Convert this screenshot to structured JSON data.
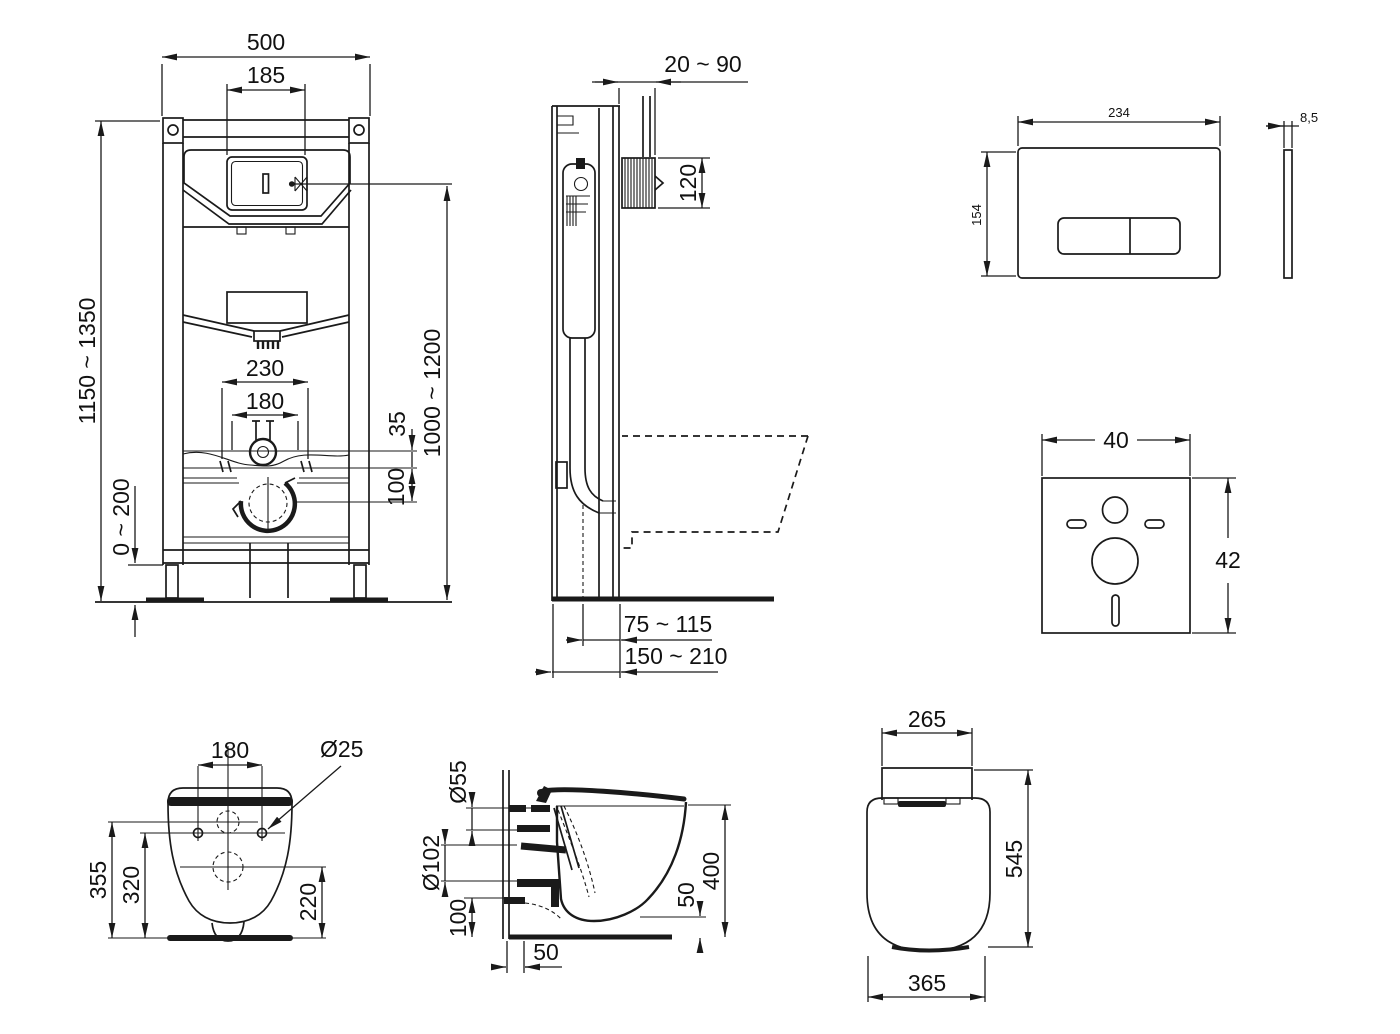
{
  "colors": {
    "line": "#1a1a1a",
    "background": "#ffffff"
  },
  "views": {
    "frame_front": {
      "dims": {
        "total_width": "500",
        "access_width": "185",
        "supply_spacing": "230",
        "bolt_spacing": "180",
        "supply_offset": "35",
        "outlet_offset": "100",
        "frame_height": "1150 ~ 1350",
        "flush_height": "1000 ~ 1200",
        "leg_adjustment": "0 ~ 200"
      }
    },
    "frame_side": {
      "dims": {
        "wall_distance": "20 ~ 90",
        "bracket_height": "120",
        "outlet_offset_front": "75 ~ 115",
        "outlet_offset_back": "150 ~ 210"
      }
    },
    "flush_plate": {
      "dims": {
        "width": "234",
        "height": "154",
        "thickness": "8,5"
      }
    },
    "sound_mat": {
      "dims": {
        "width": "40",
        "height": "42"
      }
    },
    "bowl_rear": {
      "dims": {
        "bolt_spacing": "180",
        "bolt_diameter": "Ø25",
        "inlet_height": "355",
        "bolt_height": "320",
        "outlet_height": "220"
      }
    },
    "bowl_side": {
      "dims": {
        "inlet_diameter": "Ø55",
        "outlet_diameter": "Ø102",
        "outlet_height": "100",
        "bolt_inset": "50",
        "rim_height": "50",
        "overall_height": "400"
      }
    },
    "bowl_top": {
      "dims": {
        "tank_width": "265",
        "depth": "545",
        "width": "365"
      }
    }
  }
}
